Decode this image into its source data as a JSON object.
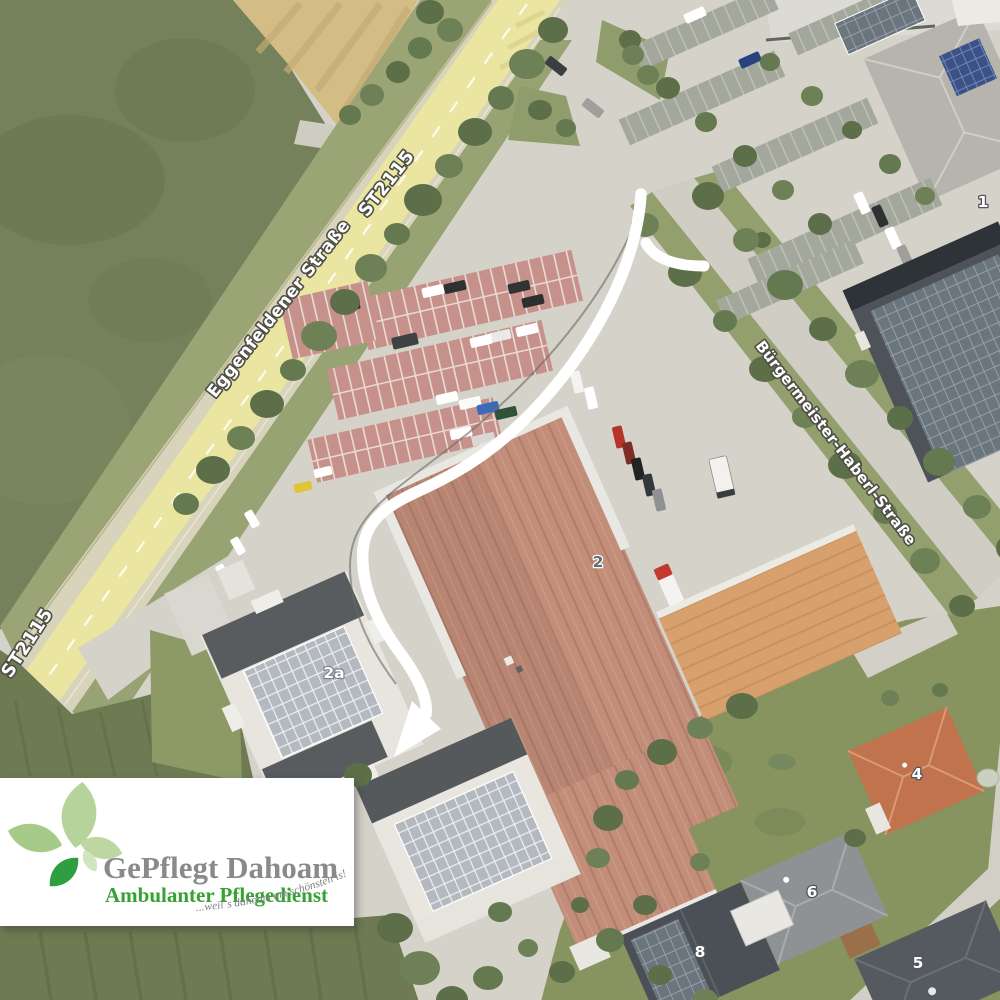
{
  "map": {
    "street_labels": [
      {
        "id": "eggenfeldener-strasse",
        "label": "Eggenfeldener Straße"
      },
      {
        "id": "st2115-upper",
        "label": "ST2115"
      },
      {
        "id": "st2115-lower",
        "label": "ST2115"
      },
      {
        "id": "buergermeister-haberl-strasse",
        "label": "Bürgermeister-Haberl-Straße"
      }
    ],
    "building_numbers": [
      {
        "id": "b1",
        "label": "1"
      },
      {
        "id": "b2",
        "label": "2"
      },
      {
        "id": "b2a",
        "label": "2a"
      },
      {
        "id": "b4",
        "label": "4"
      },
      {
        "id": "b5",
        "label": "5"
      },
      {
        "id": "b6",
        "label": "6"
      },
      {
        "id": "b8",
        "label": "8"
      }
    ]
  },
  "logo": {
    "title": "GePflegt Dahoam",
    "subtitle": "Ambulanter Pflegedienst",
    "tagline": "...weil´s dahoam am schönsten is!"
  },
  "colors": {
    "highlighted_road": "#ece79f",
    "route_arrow": "#ffffff",
    "logo_title": "#8a8a8a",
    "logo_subtitle": "#36a233",
    "logo_leaf_dark": "#2f9e41",
    "logo_leaf_light": "#b7d39c"
  }
}
